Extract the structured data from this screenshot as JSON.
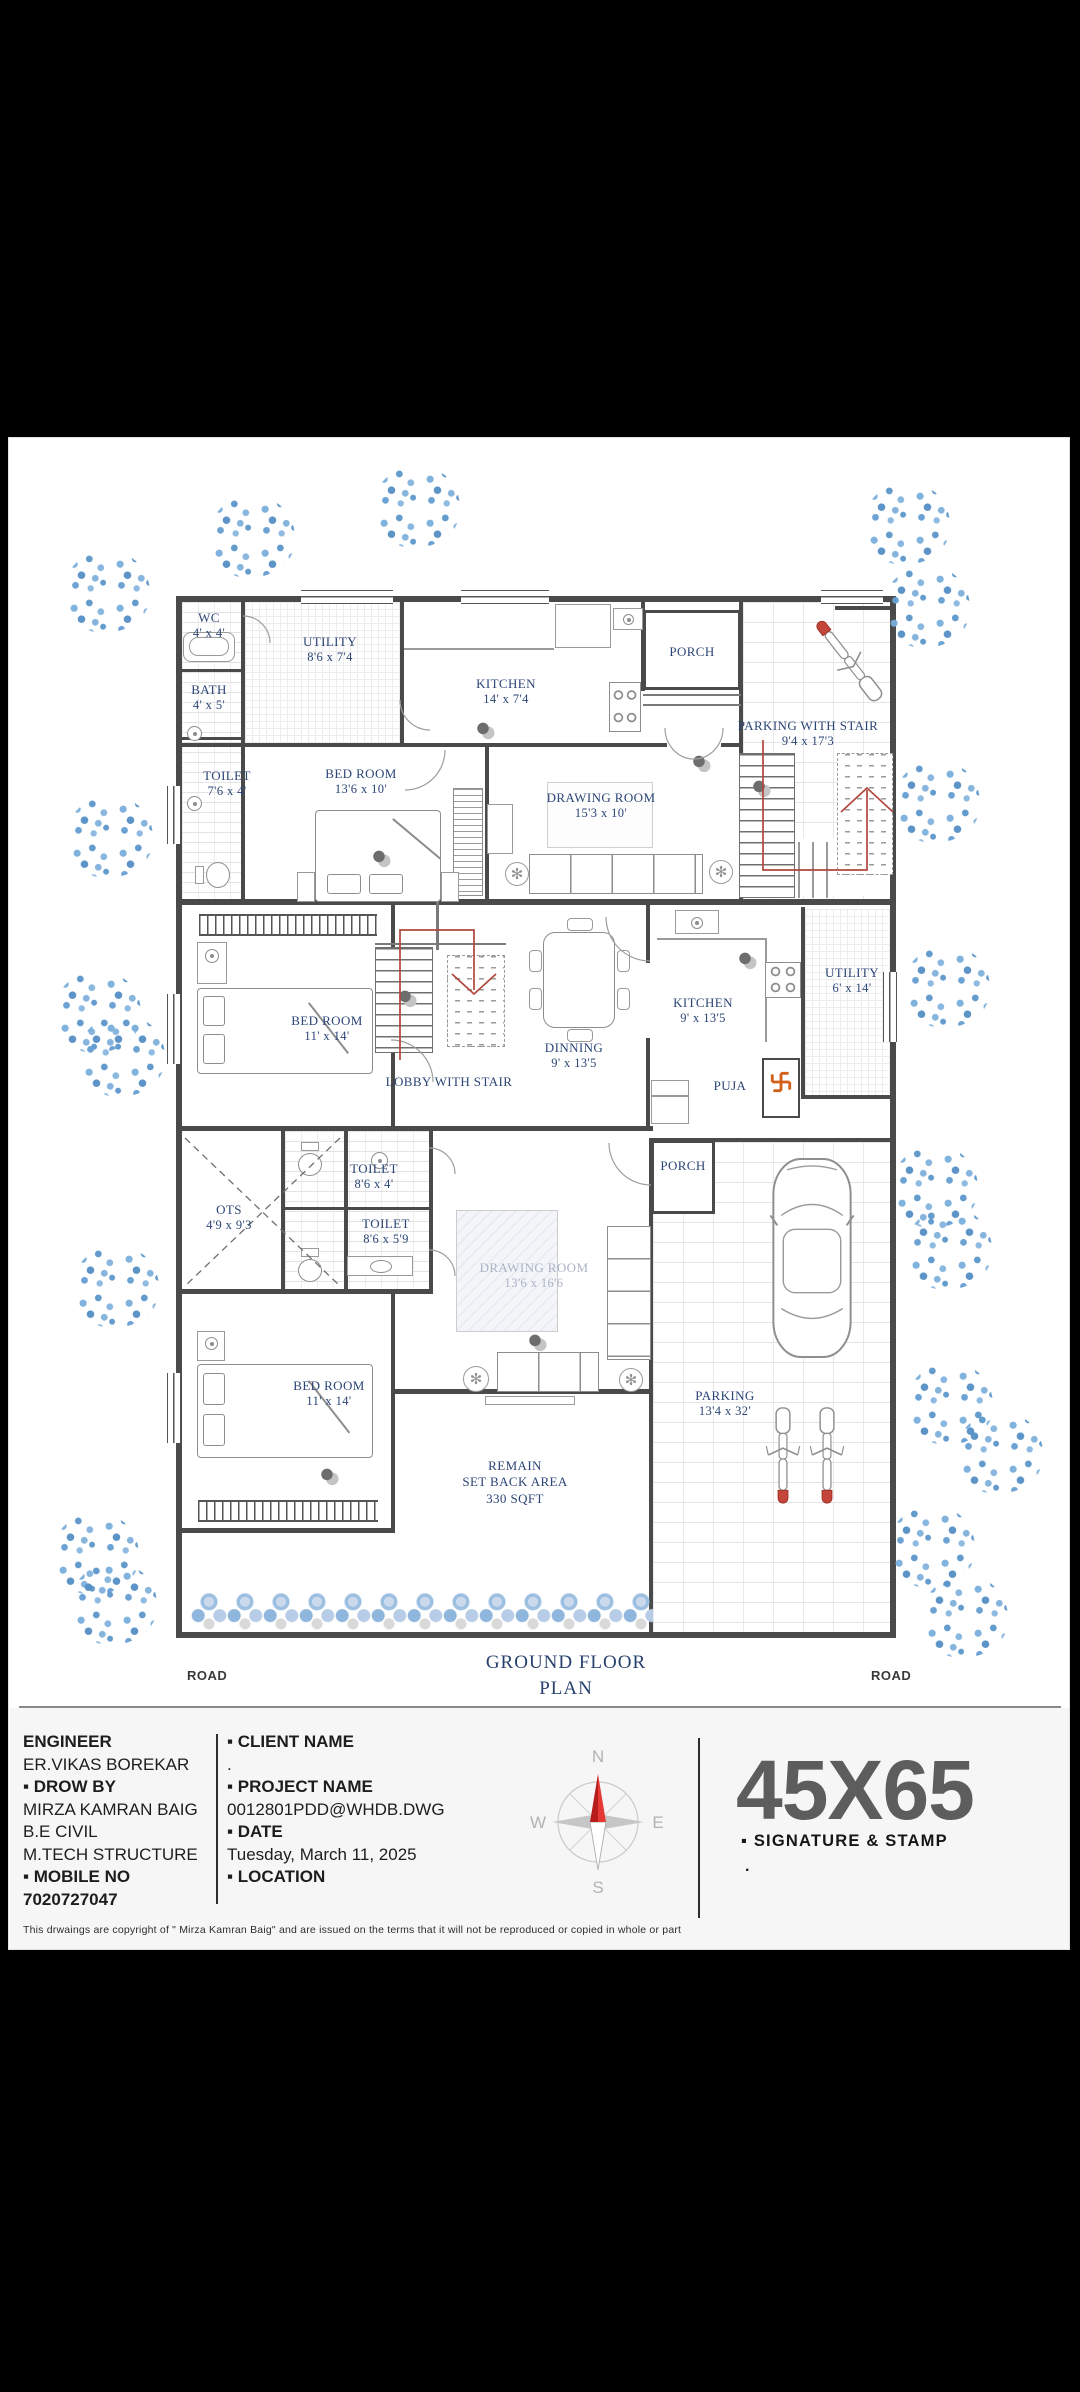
{
  "colors": {
    "wall": "#4a4a4a",
    "room_label_navy": "#2c4576",
    "tree_blue": "#6fa6d6",
    "stair_path_red": "#b0473d",
    "swastika_orange": "#d2601a",
    "plot_size_gray": "#5d5d5d",
    "compass_needle_red": "#d32f2f"
  },
  "plan": {
    "title_line1": "GROUND FLOOR",
    "title_line2": "PLAN",
    "road_left": "ROAD",
    "road_right": "ROAD",
    "rooms": {
      "wc": {
        "name": "WC",
        "dim": "4' x 4'"
      },
      "bath": {
        "name": "BATH",
        "dim": "4' x 5'"
      },
      "toilet_top": {
        "name": "TOILET",
        "dim": "7'6 x 4'"
      },
      "utility_top": {
        "name": "UTILITY",
        "dim": "8'6 x 7'4"
      },
      "kitchen_top": {
        "name": "KITCHEN",
        "dim": "14' x 7'4"
      },
      "porch_top": {
        "name": "PORCH"
      },
      "parking_stair": {
        "name": "PARKING WITH STAIR",
        "dim": "9'4 x 17'3"
      },
      "bedroom_top": {
        "name": "BED ROOM",
        "dim": "13'6 x 10'"
      },
      "drawing_top": {
        "name": "DRAWING ROOM",
        "dim": "15'3 x 10'"
      },
      "bedroom_mid": {
        "name": "BED ROOM",
        "dim": "11' x 14'"
      },
      "lobby": {
        "name": "LOBBY WITH STAIR"
      },
      "dining": {
        "name": "DINNING",
        "dim": "9' x 13'5"
      },
      "kitchen_mid": {
        "name": "KITCHEN",
        "dim": "9' x 13'5"
      },
      "utility_mid": {
        "name": "UTILITY",
        "dim": "6' x 14'"
      },
      "puja": {
        "name": "PUJA"
      },
      "ots": {
        "name": "OTS",
        "dim": "4'9 x 9'3"
      },
      "toilet_b1": {
        "name": "TOILET",
        "dim": "8'6 x 4'"
      },
      "toilet_b2": {
        "name": "TOILET",
        "dim": "8'6 x 5'9"
      },
      "drawing_bottom": {
        "name": "DRAWING ROOM",
        "dim": "13'6 x 16'6"
      },
      "porch_bottom": {
        "name": "PORCH"
      },
      "bedroom_bottom": {
        "name": "BED ROOM",
        "dim": "11' x 14'"
      },
      "setback": {
        "line1": "REMAIN",
        "line2": "SET BACK AREA",
        "line3": "330 SQFT"
      },
      "parking": {
        "name": "PARKING",
        "dim": "13'4 x 32'"
      }
    }
  },
  "titleblock": {
    "engineer_heading": "ENGINEER",
    "engineer_name": "ER.VIKAS BOREKAR",
    "drawby_heading": "▪ DROW BY",
    "drawby_name": "MIRZA KAMRAN BAIG",
    "drawby_qual1": "B.E CIVIL",
    "drawby_qual2": "M.TECH STRUCTURE",
    "mobile_heading": "▪ MOBILE NO",
    "mobile_number": "7020727047",
    "client_heading": "▪ CLIENT NAME",
    "client_value": ".",
    "project_heading": "▪ PROJECT NAME",
    "project_value": "0012801PDD@WHDB.DWG",
    "date_heading": "▪ DATE",
    "date_value": "Tuesday, March 11, 2025",
    "location_heading": "▪ LOCATION",
    "compass": {
      "n": "N",
      "e": "E",
      "s": "S",
      "w": "W"
    },
    "plot_size": "45X65",
    "signature_heading": "▪ SIGNATURE & STAMP",
    "signature_value": ".",
    "copyright": "This drwaings are copyright of \" Mirza Kamran Baig\" and are issued on the terms that it will not be reproduced or copied in whole or part"
  }
}
